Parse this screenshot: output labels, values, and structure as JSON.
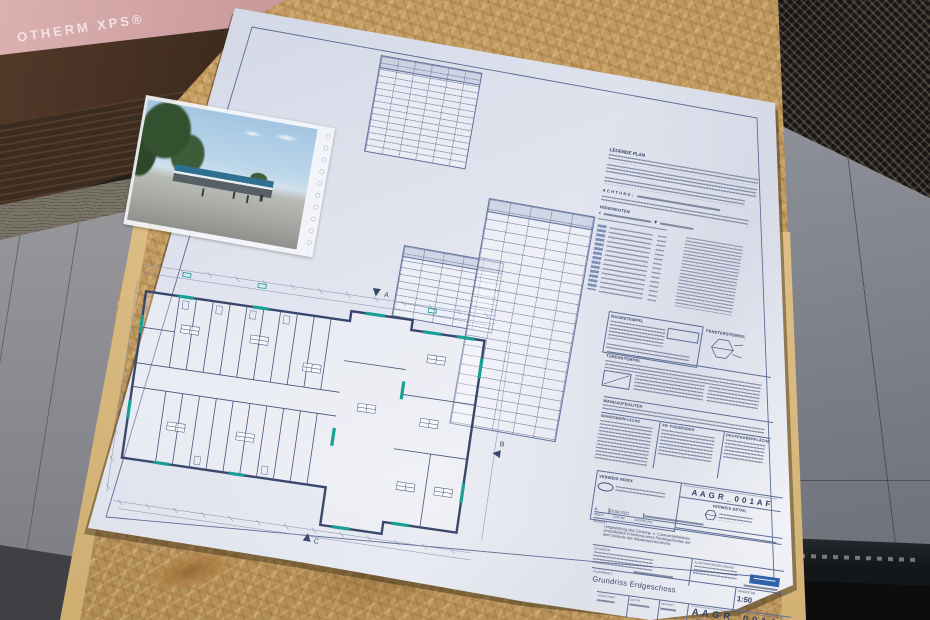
{
  "colors": {
    "ink": "#2e3c5e",
    "window_teal": "#1fa99a",
    "logo_blue": "#2f62a8",
    "osb_tan": "#c8a166",
    "xps_pink": "#d8abab"
  },
  "background": {
    "insulation_label": "OTHERM XPS®"
  },
  "sheet": {
    "legend": {
      "title": "LEGENDE PLAN",
      "warning": "ACHTUNG:",
      "heights_title": "HÖHENKOTEN"
    },
    "stamps": {
      "room": "RAUMSTEMPEL",
      "window": "FENSTERSTEMPEL",
      "door": "TÜRENSTEMPEL",
      "walls": "WANDAUFBAUTEN",
      "wall_surface": "WANDOBERFLÄCHE",
      "fb": "FB",
      "floor": "FUSSBODEN",
      "ceiling": "DECKENOBERFLÄCHE"
    },
    "plan": {
      "sections": [
        "A",
        "B",
        "C"
      ]
    },
    "titleblock": {
      "ref_index_label": "VERWEIS INDEX",
      "ref_detail_label": "VERWEIS DETAIL",
      "plan_no": "AAGR_001AF",
      "plan_no_display": "A A G R _ 0 0 1 A F",
      "index_value": "A",
      "index_date": "20.08.2021",
      "index_cols": [
        "INDEX",
        "DATUM",
        "ÄNDERUNG"
      ],
      "project_label": "PROJEKT",
      "project_lines": [
        "Umgestaltung des Camping- u. Caravanstellplatzes",
        "einschließlich Errichtung eines Sanitärgebäudes auf",
        "dem Gelände des Wassersportzentrums"
      ],
      "client_label": "BAUHERR",
      "planner_label": "AUSFÜHRUNGSPLANUNG",
      "content_label": "PLANINHALT",
      "plan_number_label": "PLANNUMMER",
      "content_title": "Grundriss Erdgeschoss",
      "scale_label": "MASSSTAB",
      "scale_value": "1:50",
      "drawn_label": "GEZEICHNET",
      "date_label": "DATUM",
      "checked_label": "GEPRÜFT"
    }
  }
}
